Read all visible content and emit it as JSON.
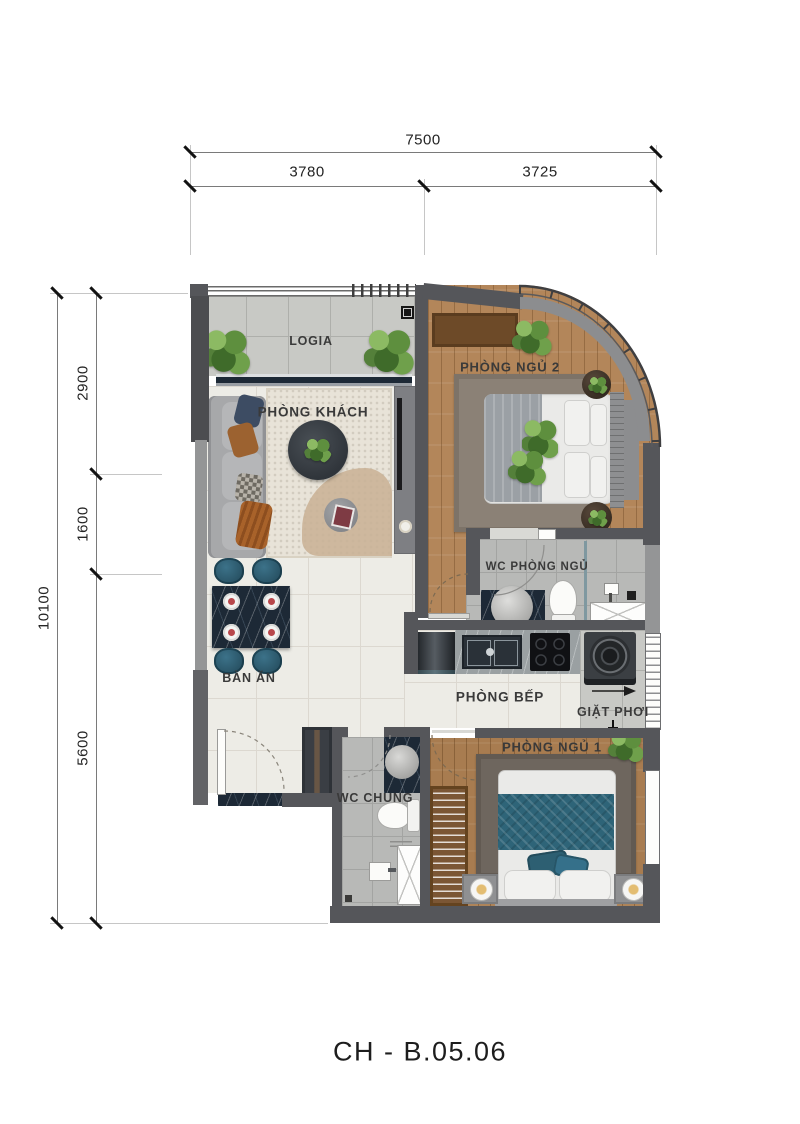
{
  "title": "CH - B.05.06",
  "dims": {
    "top_total": "7500",
    "top_seg1": "3780",
    "top_seg2": "3725",
    "left_total": "10100",
    "left_seg1": "2900",
    "left_seg2": "1600",
    "left_seg3": "5600"
  },
  "rooms": {
    "logia": {
      "label": "LOGIA"
    },
    "living": {
      "label": "PHÒNG KHÁCH"
    },
    "bedroom2": {
      "label": "PHÒNG NGỦ 2"
    },
    "wc_master": {
      "label": "WC PHÒNG NGỦ"
    },
    "kitchen": {
      "label": "PHÒNG BẾP"
    },
    "laundry": {
      "label": "GIẶT PHƠI"
    },
    "dining": {
      "label": "BÀN ĂN"
    },
    "wc_shared": {
      "label": "WC CHUNG"
    },
    "bedroom1": {
      "label": "PHÒNG NGỦ 1"
    }
  },
  "colors": {
    "wall_dark": "#55565a",
    "wood_floor": "#b3865a",
    "tile_light": "#edece6",
    "tile_gray": "#c8c9c5",
    "tile_wc": "#b8b9b7",
    "accent_teal": "#2e6478",
    "marble_dark": "#1d2936",
    "plant_green": "#5e8f3e"
  }
}
